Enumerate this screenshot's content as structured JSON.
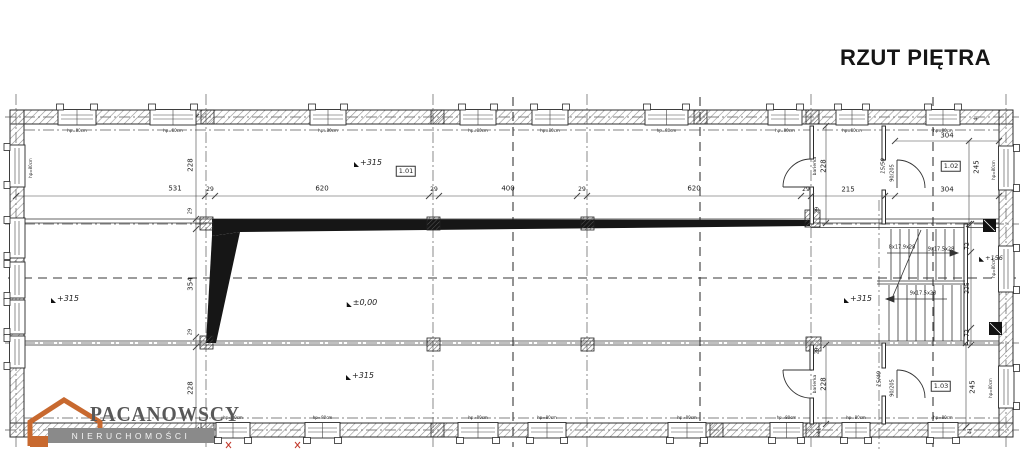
{
  "title": "RZUT PIĘTRA",
  "logo": {
    "name": "PACANOWSCY",
    "subtitle": "NIERUCHOMOŚCI"
  },
  "windows": {
    "label": "hp=80cm",
    "top": [
      [
        58,
        38
      ],
      [
        150,
        46
      ],
      [
        310,
        36
      ],
      [
        460,
        36
      ],
      [
        532,
        36
      ],
      [
        645,
        43
      ],
      [
        768,
        34
      ],
      [
        836,
        32
      ],
      [
        926,
        34
      ]
    ],
    "top_label_y": 131,
    "bottom": [
      [
        216,
        34
      ],
      [
        305,
        35
      ],
      [
        458,
        40
      ],
      [
        528,
        38
      ],
      [
        668,
        38
      ],
      [
        770,
        33
      ],
      [
        842,
        28
      ],
      [
        928,
        30
      ]
    ],
    "bottom_label_y": 418,
    "left": [
      [
        145,
        42
      ],
      [
        218,
        40
      ],
      [
        262,
        36
      ],
      [
        300,
        34
      ],
      [
        336,
        32
      ]
    ],
    "right": [
      [
        146,
        44
      ],
      [
        246,
        46
      ],
      [
        366,
        42
      ]
    ]
  },
  "annotations": [
    {
      "n": "dim-531",
      "t": "531",
      "x": 175,
      "y": 189
    },
    {
      "n": "dim-29-a",
      "t": "29",
      "x": 210,
      "y": 190,
      "fs": 6
    },
    {
      "n": "dim-620-a",
      "t": "620",
      "x": 322,
      "y": 189
    },
    {
      "n": "dim-29-b",
      "t": "29",
      "x": 434,
      "y": 190,
      "fs": 6
    },
    {
      "n": "dim-400",
      "t": "400",
      "x": 508,
      "y": 189
    },
    {
      "n": "dim-29-c",
      "t": "29",
      "x": 582,
      "y": 190,
      "fs": 6
    },
    {
      "n": "dim-620-b",
      "t": "620",
      "x": 694,
      "y": 189
    },
    {
      "n": "dim-29-d",
      "t": "29",
      "x": 806,
      "y": 190,
      "fs": 6
    },
    {
      "n": "dim-215",
      "t": "215",
      "x": 848,
      "y": 190
    },
    {
      "n": "dim-304-row",
      "t": "304",
      "x": 947,
      "y": 190
    },
    {
      "n": "dim-304-top",
      "t": "304",
      "x": 947,
      "y": 136
    },
    {
      "n": "dim-228-left-top",
      "t": "228",
      "x": 191,
      "y": 165,
      "r": -90
    },
    {
      "n": "dim-29-left-mid",
      "t": "29",
      "x": 191,
      "y": 211,
      "r": -90,
      "fs": 5
    },
    {
      "n": "dim-354",
      "t": "354",
      "x": 191,
      "y": 284,
      "r": -90
    },
    {
      "n": "dim-29-left-low",
      "t": "29",
      "x": 191,
      "y": 332,
      "r": -90,
      "fs": 5
    },
    {
      "n": "dim-228-left-bottom",
      "t": "228",
      "x": 191,
      "y": 388,
      "r": -90
    },
    {
      "n": "dim-228-barierka-top",
      "t": "228",
      "x": 824,
      "y": 166,
      "r": -90
    },
    {
      "n": "label-barierka-top",
      "t": "barierka",
      "x": 816,
      "y": 166,
      "r": -90,
      "fs": 4.5
    },
    {
      "n": "dim-29-corridor-top",
      "t": "29",
      "x": 818,
      "y": 210,
      "r": -90,
      "fs": 5
    },
    {
      "n": "dim-228-barierka-bottom",
      "t": "228",
      "x": 824,
      "y": 384,
      "r": -90
    },
    {
      "n": "label-barierka-bottom",
      "t": "barierka",
      "x": 816,
      "y": 384,
      "r": -90,
      "fs": 4.5
    },
    {
      "n": "dim-29-corridor-bottom",
      "t": "29",
      "x": 818,
      "y": 351,
      "r": -90,
      "fs": 5
    },
    {
      "n": "dim-41-a",
      "t": "41",
      "x": 820,
      "y": 431,
      "r": -90,
      "fs": 5
    },
    {
      "n": "dim-41-b",
      "t": "41",
      "x": 971,
      "y": 431,
      "r": -90,
      "fs": 5
    },
    {
      "n": "dim-245-top",
      "t": "245",
      "x": 977,
      "y": 167,
      "r": -90
    },
    {
      "n": "dim-245-bottom",
      "t": "245",
      "x": 973,
      "y": 387,
      "r": -90
    },
    {
      "n": "dim-4",
      "t": "4",
      "x": 977,
      "y": 119,
      "r": -90,
      "fs": 5
    },
    {
      "n": "stair-flight-a",
      "t": "8x17.9x28",
      "x": 902,
      "y": 248,
      "fs": 5
    },
    {
      "n": "stair-flight-b",
      "t": "9x17.5x28",
      "x": 941,
      "y": 250,
      "fs": 5
    },
    {
      "n": "stair-flight-c",
      "t": "9x17.5x28",
      "x": 923,
      "y": 294,
      "fs": 5
    },
    {
      "n": "dim-72-top",
      "t": "72",
      "x": 968,
      "y": 246,
      "r": -90,
      "fs": 6
    },
    {
      "n": "dim-225",
      "t": "225",
      "x": 968,
      "y": 288,
      "r": -90,
      "fs": 6
    },
    {
      "n": "dim-72-bottom",
      "t": "72",
      "x": 968,
      "y": 333,
      "r": -90,
      "fs": 6
    },
    {
      "n": "door-size-top",
      "t": "90/205",
      "x": 893,
      "y": 173,
      "r": -90,
      "fs": 5
    },
    {
      "n": "door-size-bottom",
      "t": "90/205",
      "x": 893,
      "y": 388,
      "r": -90,
      "fs": 5
    },
    {
      "n": "vent-size-top",
      "t": "15/50",
      "x": 884,
      "y": 166,
      "r": -90,
      "fs": 5.5,
      "s": "i"
    },
    {
      "n": "vent-size-bottom",
      "t": "15/40",
      "x": 880,
      "y": 379,
      "r": -90,
      "fs": 5.5,
      "s": "i"
    },
    {
      "n": "level-hall",
      "t": "+315",
      "x": 368,
      "y": 163,
      "f": 1,
      "fs": 8,
      "s": "i"
    },
    {
      "n": "level-left",
      "t": "+315",
      "x": 65,
      "y": 299,
      "f": 1,
      "fs": 8,
      "s": "i"
    },
    {
      "n": "level-zero",
      "t": "±0,00",
      "x": 362,
      "y": 303,
      "f": 1,
      "fs": 8,
      "s": "i"
    },
    {
      "n": "level-hall-bottom",
      "t": "+315",
      "x": 360,
      "y": 376,
      "f": 1,
      "fs": 8,
      "s": "i"
    },
    {
      "n": "level-right",
      "t": "+315",
      "x": 858,
      "y": 299,
      "f": 1,
      "fs": 8,
      "s": "i"
    },
    {
      "n": "level-stairs",
      "t": "+156",
      "x": 991,
      "y": 258,
      "f": 1,
      "fs": 6.5,
      "s": "i"
    },
    {
      "n": "room-1-01",
      "t": "1.01",
      "x": 406,
      "y": 171,
      "box": 1,
      "fs": 6.5
    },
    {
      "n": "room-1-02",
      "t": "1.02",
      "x": 951,
      "y": 166,
      "box": 1,
      "fs": 6.5
    },
    {
      "n": "room-1-03",
      "t": "1.03",
      "x": 941,
      "y": 386,
      "box": 1,
      "fs": 6.5
    },
    {
      "n": "window-label-left",
      "t": "hp=80cm",
      "x": 31,
      "y": 168,
      "r": -90,
      "fs": 4
    },
    {
      "n": "window-label-right-top",
      "t": "hp=80cm",
      "x": 994,
      "y": 170,
      "r": -90,
      "fs": 4
    },
    {
      "n": "window-label-right-mid",
      "t": "hp=80cm",
      "x": 994,
      "y": 268,
      "r": -90,
      "fs": 4
    },
    {
      "n": "window-label-right-bottom",
      "t": "hp=80cm",
      "x": 991,
      "y": 388,
      "r": -90,
      "fs": 4
    }
  ]
}
